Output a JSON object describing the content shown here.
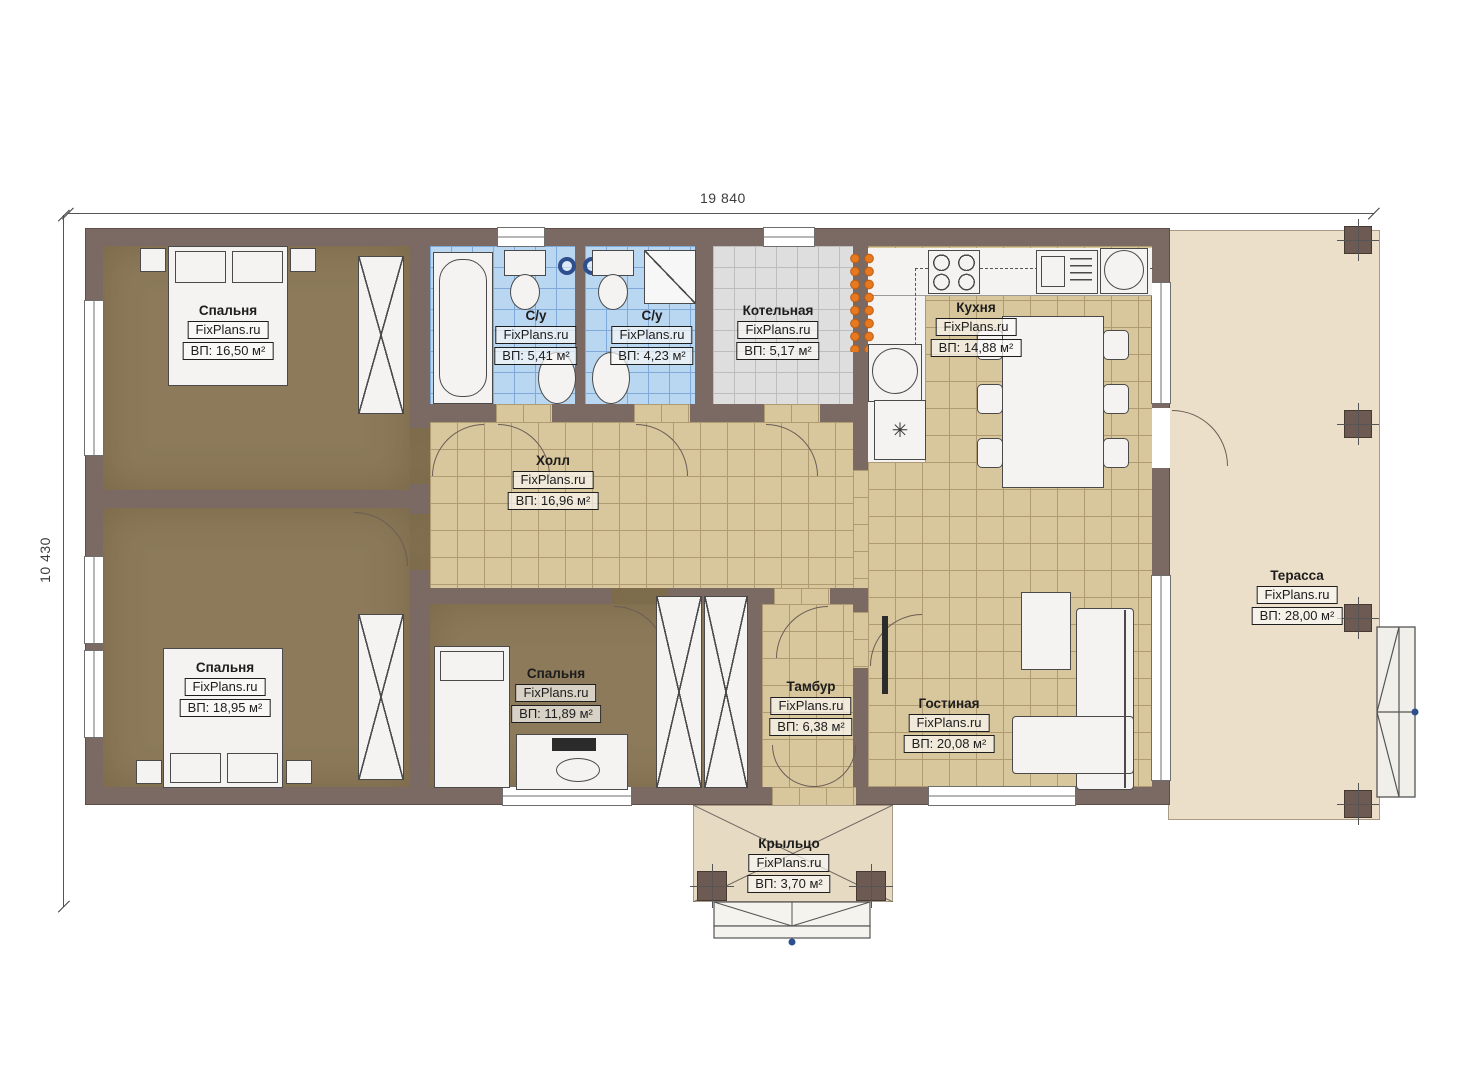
{
  "meta": {
    "watermark": "FixPlans.ru"
  },
  "dimensions": {
    "width_label": "19 840",
    "height_label": "10 430"
  },
  "rooms": {
    "bedroom1": {
      "name": "Спальня",
      "area": "ВП: 16,50 м²"
    },
    "bedroom2": {
      "name": "Спальня",
      "area": "ВП: 18,95 м²"
    },
    "bedroom3": {
      "name": "Спальня",
      "area": "ВП: 11,89 м²"
    },
    "bath1": {
      "name": "С/у",
      "area": "ВП: 5,41 м²"
    },
    "bath2": {
      "name": "С/у",
      "area": "ВП: 4,23 м²"
    },
    "boiler": {
      "name": "Котельная",
      "area": "ВП: 5,17 м²"
    },
    "kitchen": {
      "name": "Кухня",
      "area": "ВП: 14,88 м²"
    },
    "hall": {
      "name": "Холл",
      "area": "ВП: 16,96 м²"
    },
    "tambour": {
      "name": "Тамбур",
      "area": "ВП: 6,38 м²"
    },
    "living": {
      "name": "Гостиная",
      "area": "ВП: 20,08 м²"
    },
    "terrace": {
      "name": "Терасса",
      "area": "ВП: 28,00 м²"
    },
    "porch": {
      "name": "Крыльцо",
      "area": "ВП: 3,70 м²"
    }
  },
  "icons": {
    "fridge_symbol": "✳"
  },
  "colors": {
    "wall": "#7b6963",
    "bedroom_floor": "#8c7a5a",
    "tile_beige": "#d8c79c",
    "tile_blue": "#bad7f2",
    "tile_gray": "#dedede",
    "terrace_floor": "#ecdfc9",
    "manifold_orange": "#e8791e",
    "marker_blue": "#2e4f8e"
  }
}
